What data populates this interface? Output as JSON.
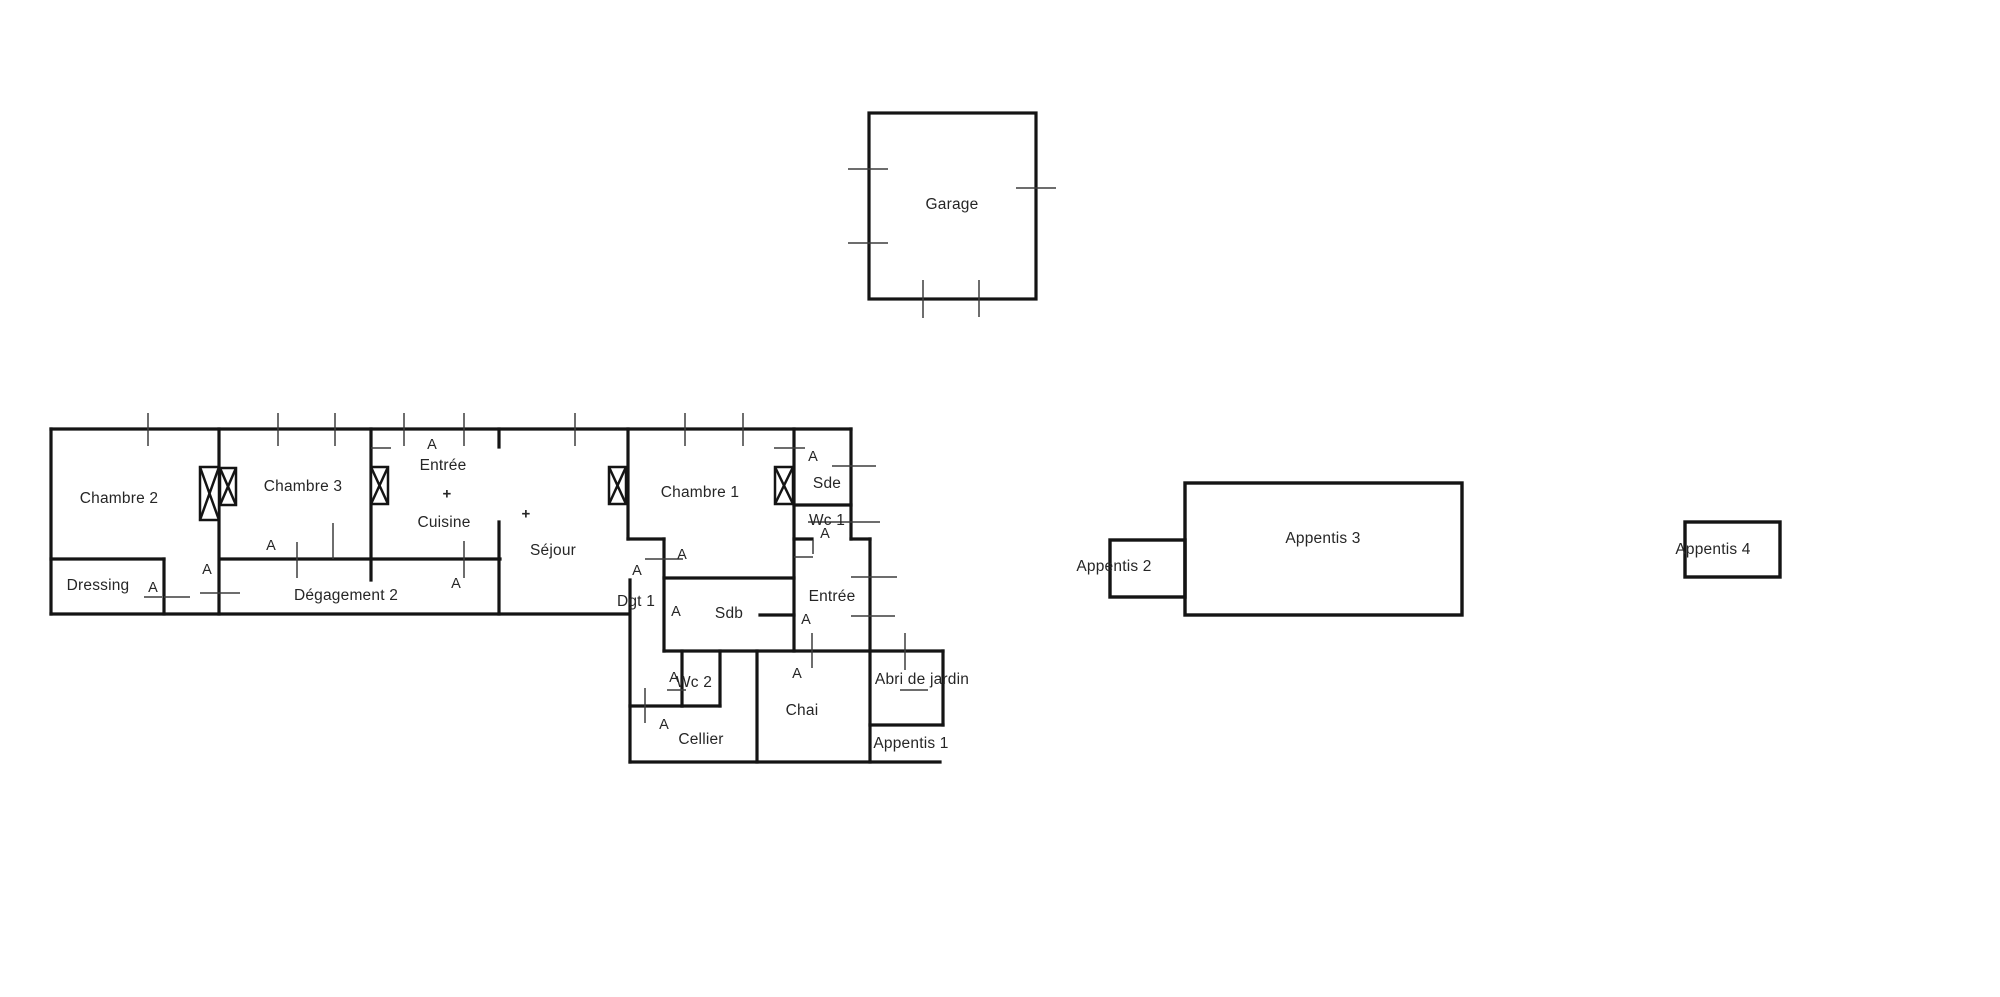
{
  "colors": {
    "wall": "#141414",
    "tick": "#3d3d3d",
    "text": "#262626",
    "background": "#ffffff"
  },
  "rooms": {
    "garage": "Garage",
    "chambre2": "Chambre 2",
    "chambre3": "Chambre 3",
    "entree_cuisine": {
      "l1": "Entrée",
      "l2": "+",
      "l3": "Cuisine"
    },
    "sejour_plus": "+",
    "sejour": "Séjour",
    "chambre1": "Chambre 1",
    "sde": "Sde",
    "wc1": "Wc 1",
    "dressing": "Dressing",
    "degagement2": "Dégagement 2",
    "dgt1": "Dgt 1",
    "sdb": "Sdb",
    "entree2": "Entrée",
    "wc2": "Wc 2",
    "chai": "Chai",
    "cellier": "Cellier",
    "abri_de_jardin": "Abri de jardin",
    "appentis1": "Appentis 1",
    "appentis2": "Appentis 2",
    "appentis3": "Appentis 3",
    "appentis4": "Appentis 4"
  },
  "markers": {
    "door": "A"
  }
}
